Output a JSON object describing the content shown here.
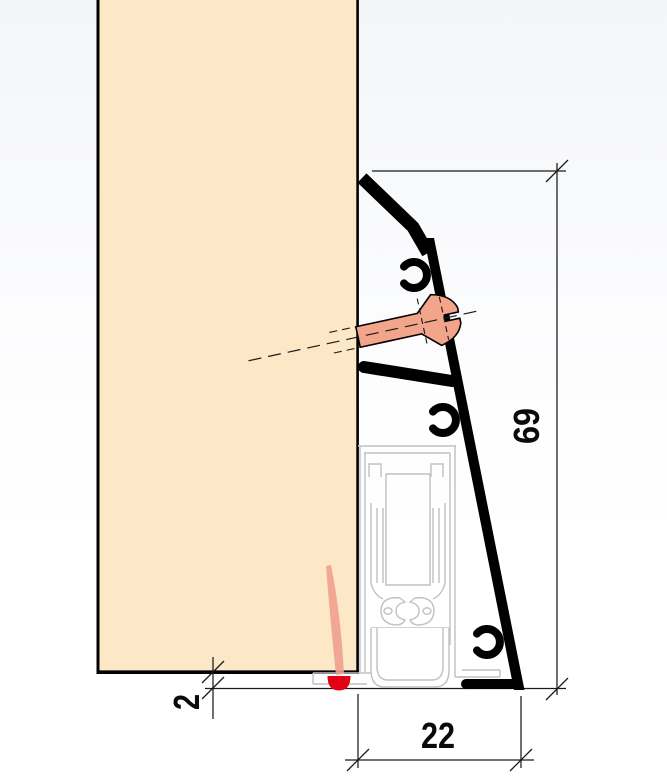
{
  "drawing": {
    "dimensions": {
      "profile_height": "69",
      "floor_clearance": "2",
      "profile_depth": "22"
    },
    "colors": {
      "door_fill": "#fce8c7",
      "screw_fill": "#f2a58a",
      "pin_fill": "#efa08d",
      "indicator_red": "#e30015",
      "seal_outline_gray": "#c0c0c0",
      "profile_black": "#000000",
      "line_black": "#1a1a1a"
    }
  }
}
